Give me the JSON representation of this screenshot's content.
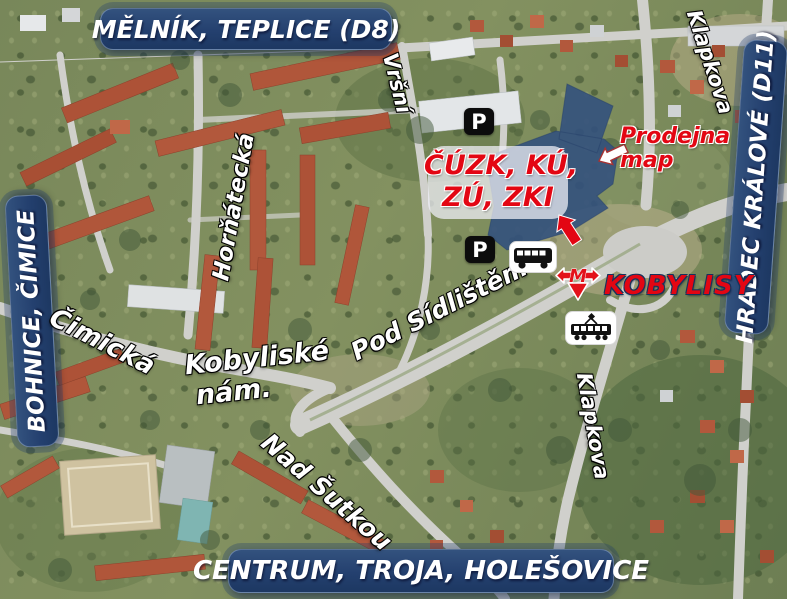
{
  "banners": {
    "top": "MĚLNÍK, TEPLICE (D8)",
    "left": "BOHNICE, ČIMICE",
    "right": "HRADEC KRÁLOVÉ (D11)",
    "bottom": "CENTRUM, TROJA, HOLEŠOVICE"
  },
  "streets": {
    "vrsni": "Vršní",
    "hornatecka": "Horňátecká",
    "cimicka": "Čimická",
    "kobyliske_line1": "Kobyliské",
    "kobyliske_line2": "nám.",
    "pod_sidlistem": "Pod Sídlištěm",
    "nad_sutkou": "Nad Šutkou",
    "klapkova_north": "Klapkova",
    "klapkova_south": "Klapkova"
  },
  "labels": {
    "office_line1": "ČÚZK, KÚ,",
    "office_line2": "ZÚ, ZKI",
    "map_shop_line1": "Prodejna",
    "map_shop_line2": "map",
    "metro_station": "KOBYLISY",
    "parking": "P"
  },
  "icons": {
    "metro": "prague-metro-logo",
    "bus": "bus-icon",
    "tram": "tram-icon",
    "parking_north": "parking-icon",
    "parking_south": "parking-icon",
    "red_arrow": "building-pointer-arrow",
    "white_arrow": "map-shop-pointer-arrow"
  },
  "colors": {
    "banner_blue": "#24406f",
    "label_red": "#e30613",
    "building_overlay_blue": "#33517d"
  }
}
